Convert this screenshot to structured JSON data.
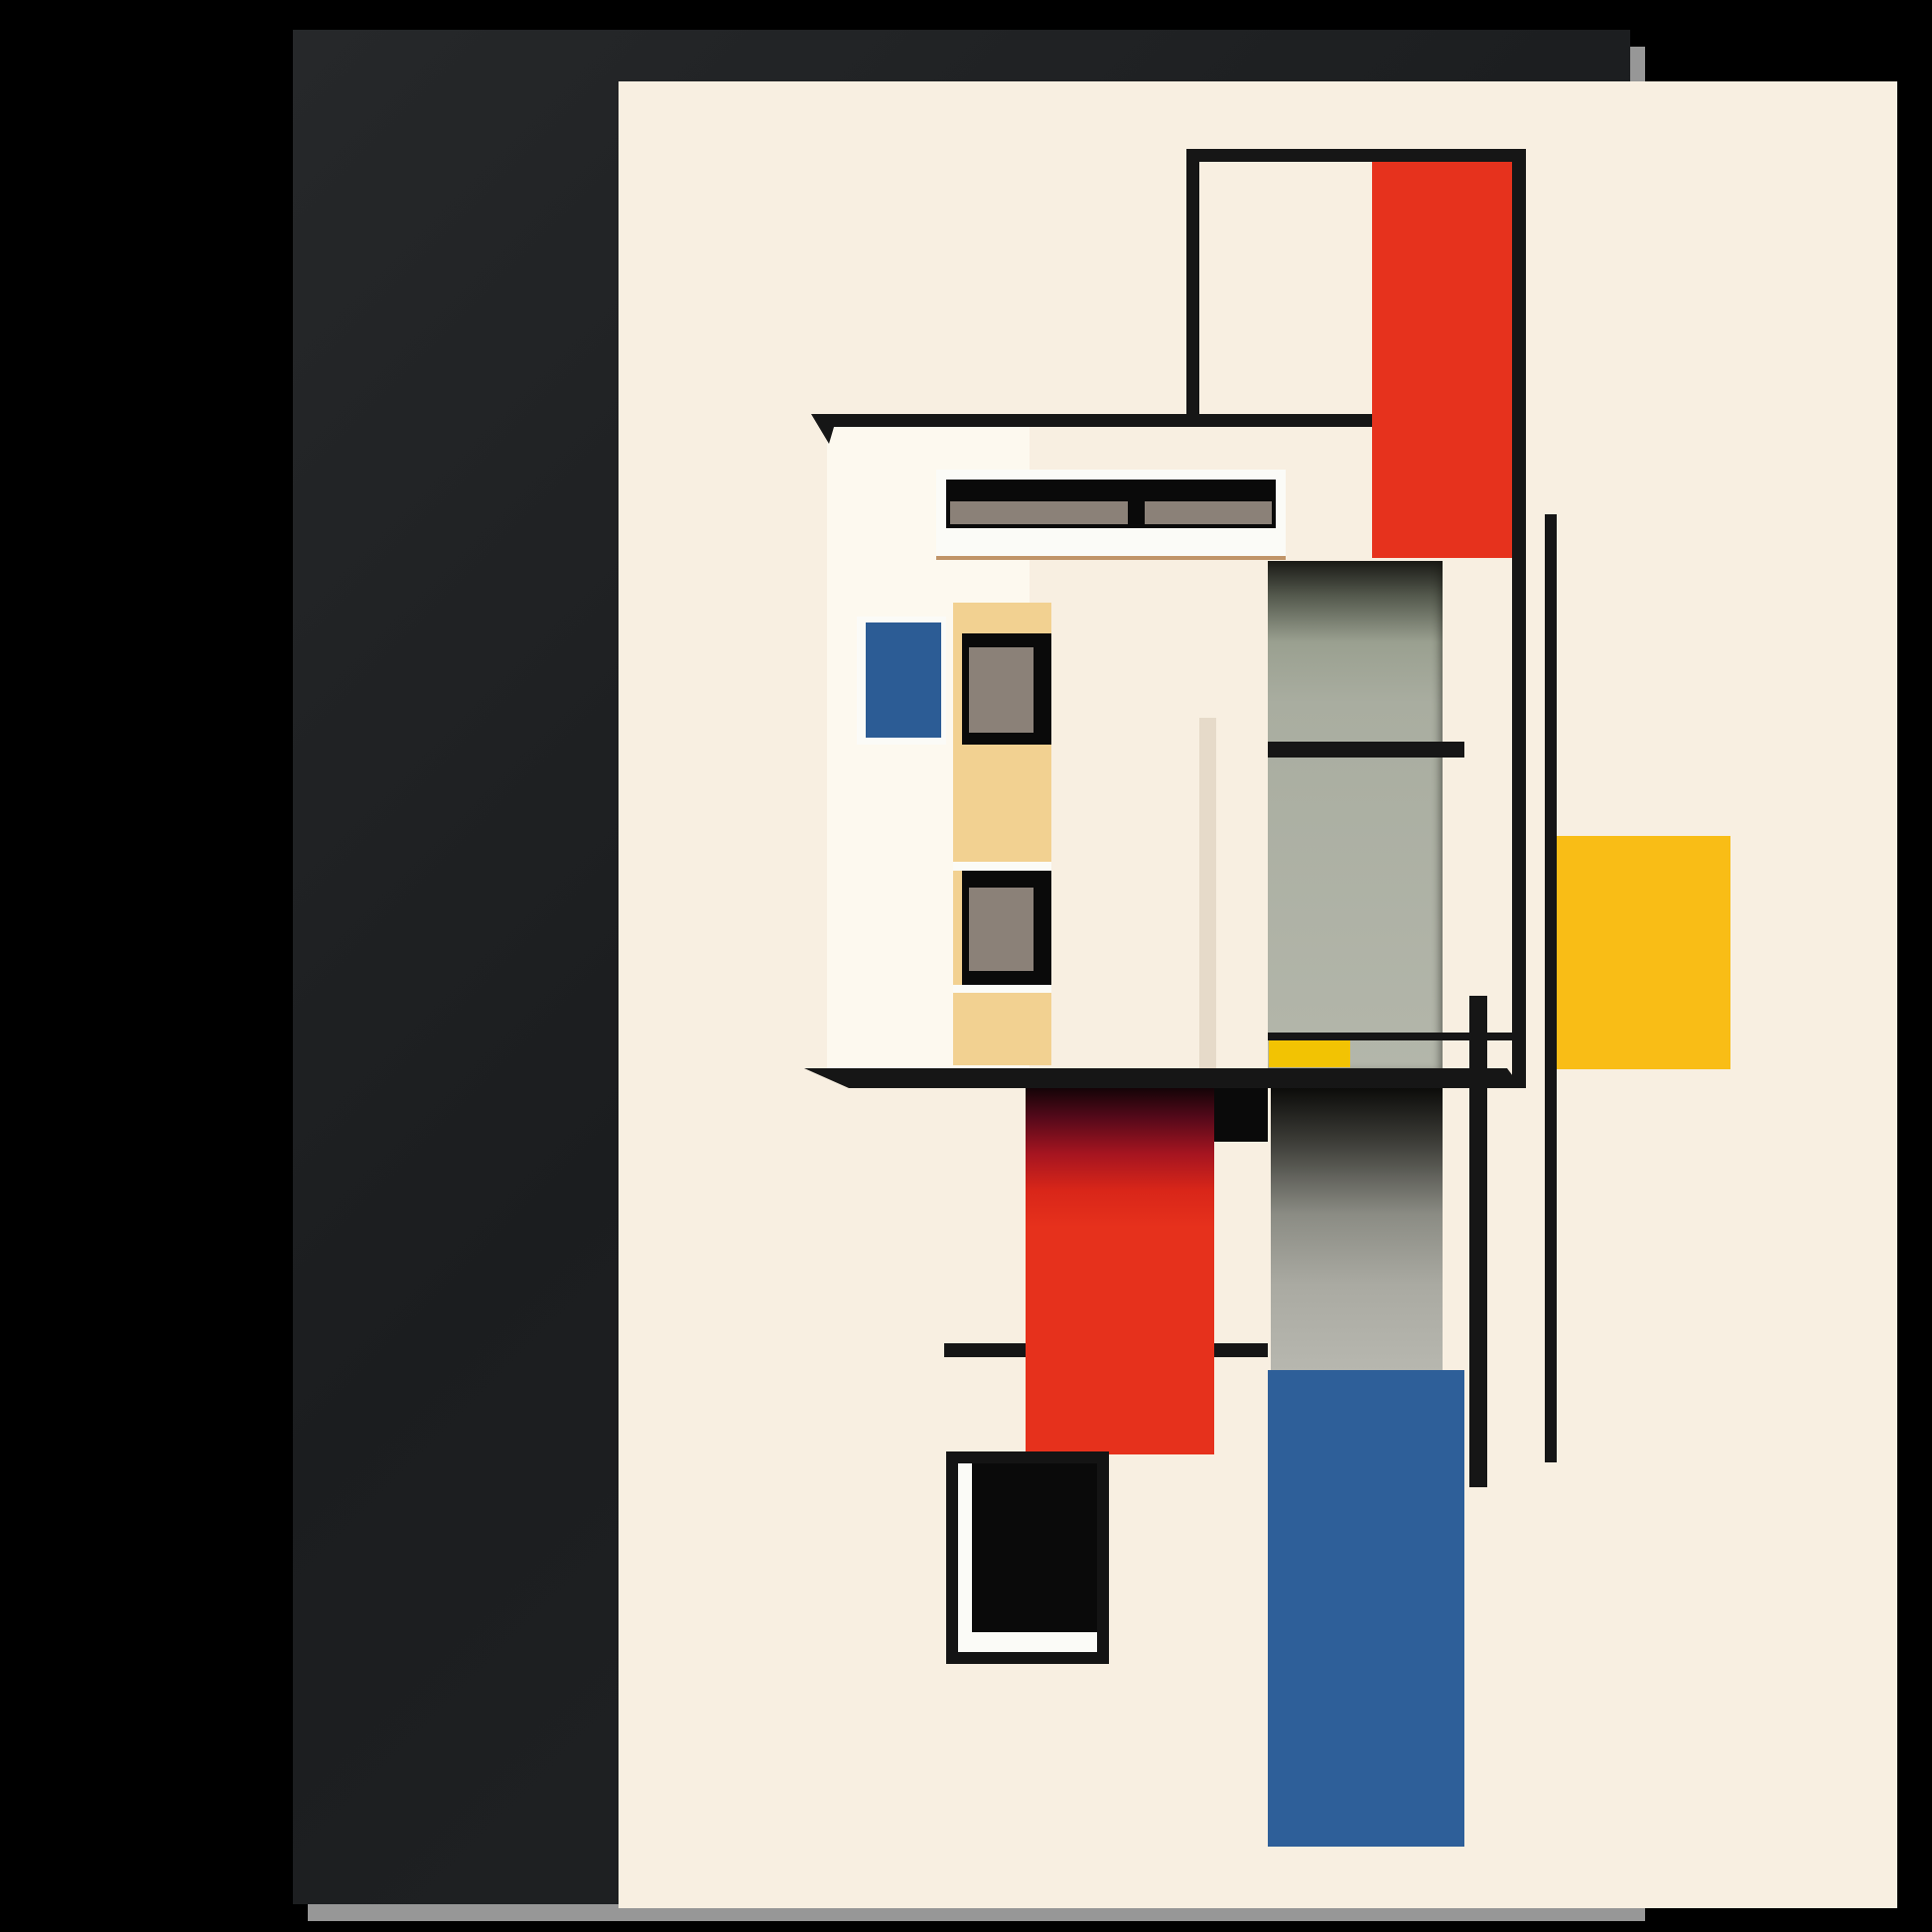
{
  "artwork": {
    "title": "",
    "style": "bauhaus-de-stijl-architectural-composition",
    "description": "Framed poster: abstract modernist house built from black outlines, red, blue, yellow, gray and tan blocks on cream",
    "elements": [
      "black-gallery-frame",
      "cream-canvas",
      "outlined-rectangle-top",
      "red-rectangle-top",
      "roof-line",
      "house-wall",
      "clerestory-window-strip",
      "blue-window-square",
      "tan-window-column",
      "dark-window-upper",
      "dark-window-lower",
      "recessed-gray-panel",
      "panel-cross-bar",
      "large-yellow-square",
      "small-yellow-ledge-block",
      "balcony-ledge",
      "vertical-line-a",
      "vertical-line-b",
      "vertical-line-c",
      "thin-rail-line",
      "red-column-lower",
      "gray-column-lower",
      "blue-column-lower",
      "side-rail-segments",
      "black-open-frame-square"
    ]
  },
  "palette": {
    "backdrop": "#000000",
    "frame_wood": "linear-gradient(135deg,#26282a 0%,#1b1d1f 45%,#232527 100%)",
    "frame_shadow": "#979797",
    "canvas_cream": "#f8efe1",
    "wall_white": "#fdf9ef",
    "wall_shade": "rgba(120,95,55,0.14)",
    "ink_black": "#161616",
    "red_flat": "#e6321d",
    "red_column_gradient": "linear-gradient(180deg,#140407 0%,#55091a 8%,#a61520 18%,#d92619 28%,#e6311c 38%,#e6311c 100%)",
    "blue_square": "#2c5c95",
    "blue_column": "#2e5f99",
    "yellow_large": "#f9bd16",
    "yellow_small": "#f2c303",
    "tan_panel": "#f2d191",
    "window_pane_gray": "#8b8178",
    "panel_gray_gradient": "linear-gradient(180deg,#1a1a16 0%,#555a4e 7%,#9aa090 16%,#a9ada0 28%,#b3b6aa 100%)",
    "gray_column_gradient": "linear-gradient(180deg,#0c0c0a 0%,#3a3a35 18%,#8b8c84 45%,#aaaaa2 70%,#b7b7af 100%)",
    "trim_white": "#fbfbf7",
    "sill_underline": "#c09468",
    "block_black": "#0a0a0a"
  }
}
